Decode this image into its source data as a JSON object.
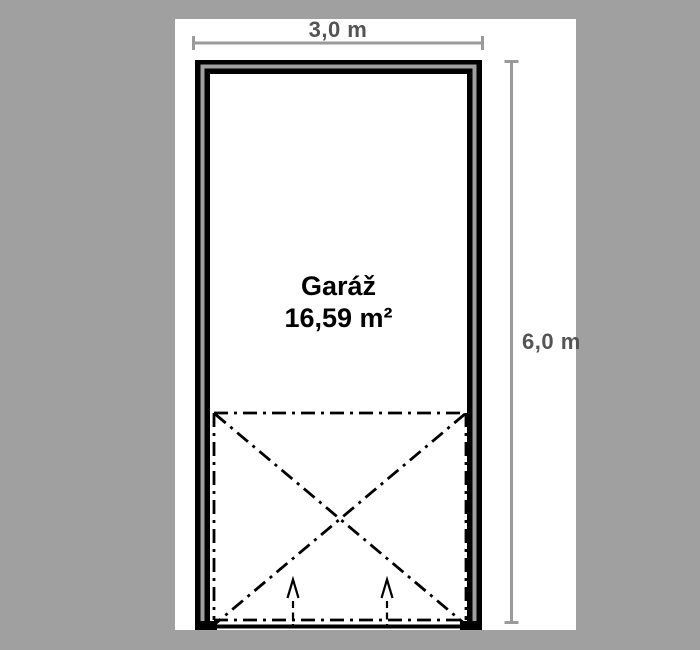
{
  "plan": {
    "room": {
      "name": "Garáž",
      "area": "16,59 m²"
    },
    "dimensions": {
      "width": "3,0 m",
      "height": "6,0 m"
    }
  },
  "colors": {
    "background": "#a0a0a0",
    "paper": "#ffffff",
    "wall": "#000000",
    "wall_core": "#a0a0a0",
    "door_swing_line": "#000000",
    "dimension_line": "#9a9a9a",
    "dimension_text": "#545454",
    "room_text": "#000000"
  }
}
